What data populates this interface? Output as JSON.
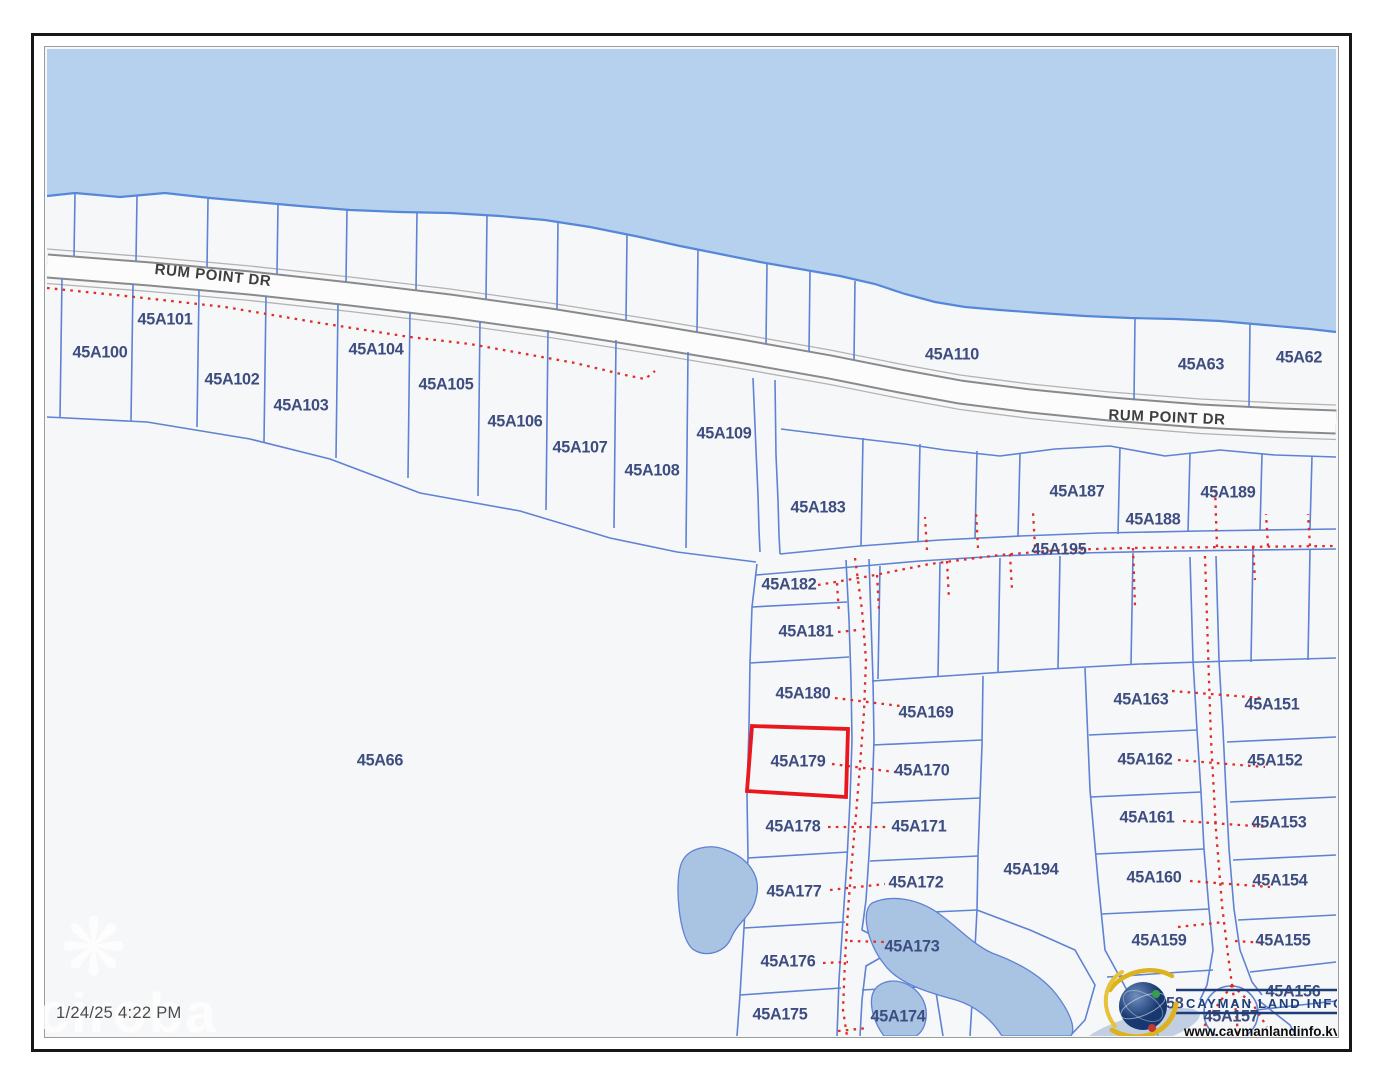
{
  "page": {
    "timestamp": "1/24/25 4:22 PM"
  },
  "watermark": {
    "text": "ciroba",
    "icon": "flower-icon"
  },
  "branding": {
    "org": "CAYMAN LAND INFO",
    "url": "www.caymanlandinfo.ky"
  },
  "map": {
    "colors": {
      "sea": "#b6d1ee",
      "land": "#f6f7f9",
      "shore": "#5588d8",
      "parcel_line": "#5f82d4",
      "road_casing": "#8a8a8a",
      "road_fill": "#fcfcfd",
      "road_shoulder": "#b3b3b3",
      "label": "#3e4d80",
      "road_label": "#3f3f3f",
      "easement": "#e12d28",
      "highlight": "#e8181d",
      "pond": "#a8c4e2",
      "brand_navy": "#1c3e78",
      "brand_gold": "#dcb31c",
      "logo_green": "#35a04a",
      "logo_red": "#c03a32"
    },
    "highlight": {
      "parcel": "45A179",
      "points": "752,726 848,729 846,797 747,791"
    },
    "road_labels": [
      {
        "text": "RUM POINT DR",
        "x": 213,
        "y": 275,
        "rot": 6
      },
      {
        "text": "RUM POINT DR",
        "x": 1167,
        "y": 417,
        "rot": 2.5
      }
    ],
    "parcel_labels": [
      {
        "t": "45A100",
        "x": 100,
        "y": 352
      },
      {
        "t": "45A101",
        "x": 165,
        "y": 319
      },
      {
        "t": "45A102",
        "x": 232,
        "y": 379
      },
      {
        "t": "45A103",
        "x": 301,
        "y": 405
      },
      {
        "t": "45A104",
        "x": 376,
        "y": 349
      },
      {
        "t": "45A105",
        "x": 446,
        "y": 384
      },
      {
        "t": "45A106",
        "x": 515,
        "y": 421
      },
      {
        "t": "45A107",
        "x": 580,
        "y": 447
      },
      {
        "t": "45A108",
        "x": 652,
        "y": 470
      },
      {
        "t": "45A109",
        "x": 724,
        "y": 433
      },
      {
        "t": "45A110",
        "x": 952,
        "y": 354
      },
      {
        "t": "45A63",
        "x": 1201,
        "y": 364
      },
      {
        "t": "45A62",
        "x": 1299,
        "y": 357
      },
      {
        "t": "45A183",
        "x": 818,
        "y": 507
      },
      {
        "t": "45A187",
        "x": 1077,
        "y": 491
      },
      {
        "t": "45A188",
        "x": 1153,
        "y": 519
      },
      {
        "t": "45A189",
        "x": 1228,
        "y": 492
      },
      {
        "t": "45A195",
        "x": 1059,
        "y": 549
      },
      {
        "t": "45A182",
        "x": 789,
        "y": 584
      },
      {
        "t": "45A181",
        "x": 806,
        "y": 631
      },
      {
        "t": "45A180",
        "x": 803,
        "y": 693
      },
      {
        "t": "45A179",
        "x": 798,
        "y": 761
      },
      {
        "t": "45A169",
        "x": 926,
        "y": 712
      },
      {
        "t": "45A170",
        "x": 922,
        "y": 770
      },
      {
        "t": "45A178",
        "x": 793,
        "y": 826
      },
      {
        "t": "45A171",
        "x": 919,
        "y": 826
      },
      {
        "t": "45A177",
        "x": 794,
        "y": 891
      },
      {
        "t": "45A172",
        "x": 916,
        "y": 882
      },
      {
        "t": "45A176",
        "x": 788,
        "y": 961
      },
      {
        "t": "45A173",
        "x": 912,
        "y": 946
      },
      {
        "t": "45A175",
        "x": 780,
        "y": 1014
      },
      {
        "t": "45A174",
        "x": 898,
        "y": 1016
      },
      {
        "t": "45A194",
        "x": 1031,
        "y": 869
      },
      {
        "t": "45A163",
        "x": 1141,
        "y": 699
      },
      {
        "t": "45A162",
        "x": 1145,
        "y": 759
      },
      {
        "t": "45A161",
        "x": 1147,
        "y": 817
      },
      {
        "t": "45A160",
        "x": 1154,
        "y": 877
      },
      {
        "t": "45A159",
        "x": 1159,
        "y": 940
      },
      {
        "t": "45A151",
        "x": 1272,
        "y": 704
      },
      {
        "t": "45A152",
        "x": 1275,
        "y": 760
      },
      {
        "t": "45A153",
        "x": 1279,
        "y": 822
      },
      {
        "t": "45A154",
        "x": 1280,
        "y": 880
      },
      {
        "t": "45A155",
        "x": 1283,
        "y": 940
      },
      {
        "t": "45A156",
        "x": 1293,
        "y": 991
      },
      {
        "t": "45A157",
        "x": 1231,
        "y": 1016
      },
      {
        "t": "45A158",
        "x": 1156,
        "y": 1003
      },
      {
        "t": "45A66",
        "x": 380,
        "y": 760
      }
    ],
    "geometry": {
      "shoreline": "47,196 75,193 120,197 165,193 210,198 255,202 300,206 350,210 400,212 450,213 500,216 545,220 590,227 635,236 680,246 720,254 760,262 800,269 840,276 875,284 905,294 935,302 965,307 1000,310 1040,313 1085,316 1130,318 1175,319 1220,321 1265,325 1310,329 1336,332",
      "main_road": "47,266 150,274 250,283 350,294 450,306 550,320 650,336 740,351 830,367 900,381 960,392 1030,401 1110,409 1200,416 1280,420 1336,422",
      "parcel_lines": [
        "75,194 74,256",
        "137,196 136,261",
        "208,199 207,267",
        "278,204 277,274",
        "347,209 346,282",
        "417,212 416,290",
        "487,215 486,299",
        "558,221 557,309",
        "627,235 626,320",
        "698,249 697,332",
        "767,263 766,344",
        "810,271 809,352",
        "855,281 854,360",
        "1135,318 1134,400",
        "1250,323 1249,407",
        "62,278 60,418",
        "133,284 131,421",
        "199,290 197,427",
        "266,296 264,442",
        "338,304 336,458",
        "410,312 408,478",
        "480,321 478,496",
        "548,330 546,510",
        "616,340 614,528",
        "688,352 686,548",
        "47,417 147,422 250,439 330,459 420,493 520,511 610,538 677,552 756,562",
        "753,378 756,450 758,495 759,530 760,552",
        "775,380 776,455 778,500 779,535 780,554",
        "780,554 860,546 940,540 1020,536 1100,533 1200,531 1336,529",
        "756,575 840,568 920,561 1000,556 1080,553 1180,551 1336,549",
        "781,429 845,437 905,444 945,450 1000,456 1055,449 1110,446 1165,456 1220,450 1275,455 1336,457",
        "863,438 861,546",
        "920,444 918,541",
        "977,451 975,539",
        "1020,453 1018,537",
        "1120,447 1118,534",
        "1190,453 1188,532",
        "1262,454 1260,530",
        "1312,456 1310,529",
        "880,566 878,679",
        "940,562 938,676",
        "1000,558 998,672",
        "1060,556 1058,668",
        "1133,553 1131,665",
        "1253,551 1251,662",
        "1310,550 1308,660",
        "872,681 960,675 1050,669 1140,664 1230,661 1336,658",
        "757,564 752,607 750,663 749,726 747,795 748,858 744,928 740,995 737,1036",
        "752,607 847,602",
        "750,663 849,657",
        "748,858 848,852",
        "744,928 845,922",
        "740,995 841,988",
        "846,560 849,620 851,680 852,740 850,800 847,860 843,920 839,980 837,1036",
        "869,559 871,620 873,680 874,740 872,800 869,855 866,900 862,930 878,938 880,958 866,966 862,1000 860,1036",
        "873,745 982,740",
        "872,803 980,798",
        "870,861 978,856",
        "867,915 977,910",
        "862,990 935,986",
        "983,676 982,745 980,800 978,856 977,910 973,987 970,1036",
        "935,986 943,1036",
        "1085,668 1090,790 1098,880 1105,950 1128,992 1152,1016 1158,1036",
        "1089,735 1197,730",
        "1091,797 1201,792",
        "1096,854 1204,849",
        "1101,914 1209,909",
        "1107,977 1213,970",
        "1190,557 1193,660 1197,730 1201,792 1204,849 1209,909 1213,950 1207,985 1200,1000",
        "1216,556 1219,660 1223,730 1226,792 1229,849 1234,909 1240,950 1252,982 1262,995",
        "1227,742 1336,737",
        "1230,802 1336,797",
        "1233,860 1336,855",
        "1238,920 1336,915",
        "1250,972 1336,962",
        "1256,1010 1336,1001",
        "1258,1000 1290,1025 1296,1036",
        "977,910 1030,930 1075,950 1095,985 1085,1020 1070,1036"
      ],
      "circles": [
        {
          "cx": 1231,
          "cy": 1013,
          "r": 27
        }
      ],
      "ponds": [
        "M682,862 C688,848 710,843 726,850 C748,858 762,876 756,898 C752,916 738,922 732,936 C726,952 708,958 694,950 C678,940 674,878 682,862 Z",
        "M872,903 C892,894 918,899 938,913 C958,927 972,944 992,953 C1014,961 1040,974 1056,994 C1070,1012 1076,1028 1071,1036 L1002,1036 C992,1020 976,1006 956,1000 C930,993 898,984 884,964 C868,944 860,912 872,903 Z",
        "M878,986 C892,976 912,982 922,998 C930,1012 926,1030 916,1036 L884,1036 C872,1020 866,996 878,986 Z"
      ],
      "easements": [
        "47,288 135,297 225,307 320,323 410,337 470,344 520,353 575,363 625,375 645,379 655,371",
        "818,585 870,576 930,564 1000,555 1060,550 1130,548 1230,547 1336,546",
        "927,550 925,517",
        "978,548 976,512",
        "1035,547 1033,512",
        "1217,547 1215,488",
        "1268,546 1266,514",
        "1310,546 1308,514",
        "837,583 839,614",
        "877,575 879,610",
        "947,561 949,600",
        "1010,554 1012,590",
        "1133,548 1135,607",
        "1253,547 1255,580",
        "855,558 862,610 866,660 864,712 860,765 856,815 852,860 848,910 845,960 843,1010 847,1036",
        "838,632 858,630",
        "835,698 900,706",
        "832,764 895,772",
        "828,827 890,827",
        "830,890 885,884",
        "823,963 848,962",
        "850,941 885,942",
        "838,1031 868,1028",
        "1205,556 1208,650 1211,740 1216,830 1222,905 1228,955 1232,985",
        "1232,985 1214,1010 1202,1030",
        "1232,985 1236,1012 1238,1034",
        "1232,985 1254,1006 1267,1027",
        "1172,691 1262,698",
        "1178,760 1265,767",
        "1183,821 1268,827",
        "1190,881 1270,887",
        "1178,927 1224,922",
        "1235,941 1266,943"
      ]
    }
  }
}
